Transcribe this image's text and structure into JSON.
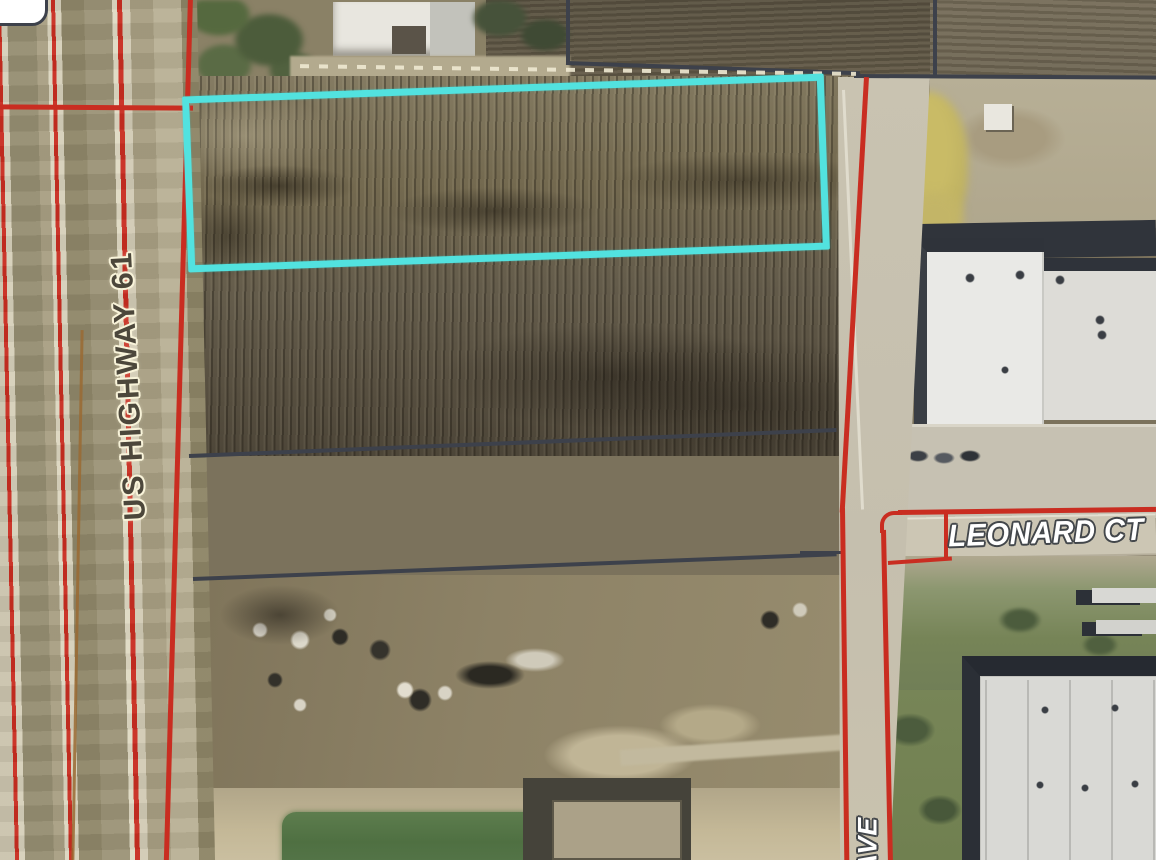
{
  "map": {
    "labels": {
      "highway": "US HIGHWAY 61",
      "street": "LEONARD CT",
      "avenue_suffix": "AVE"
    },
    "selection": {
      "shape": "rectangle",
      "description": "highlighted parcel outline over plowed field"
    },
    "colors": {
      "parcel_line_red": "#c92d21",
      "boundary_line_dark": "#3d414b",
      "selection_cyan": "#52e2df",
      "highway_label_text": "#4c473b",
      "highway_label_halo": "#f8f3d9",
      "street_label_text": "#ffffff",
      "street_label_outline": "#43474b"
    }
  }
}
